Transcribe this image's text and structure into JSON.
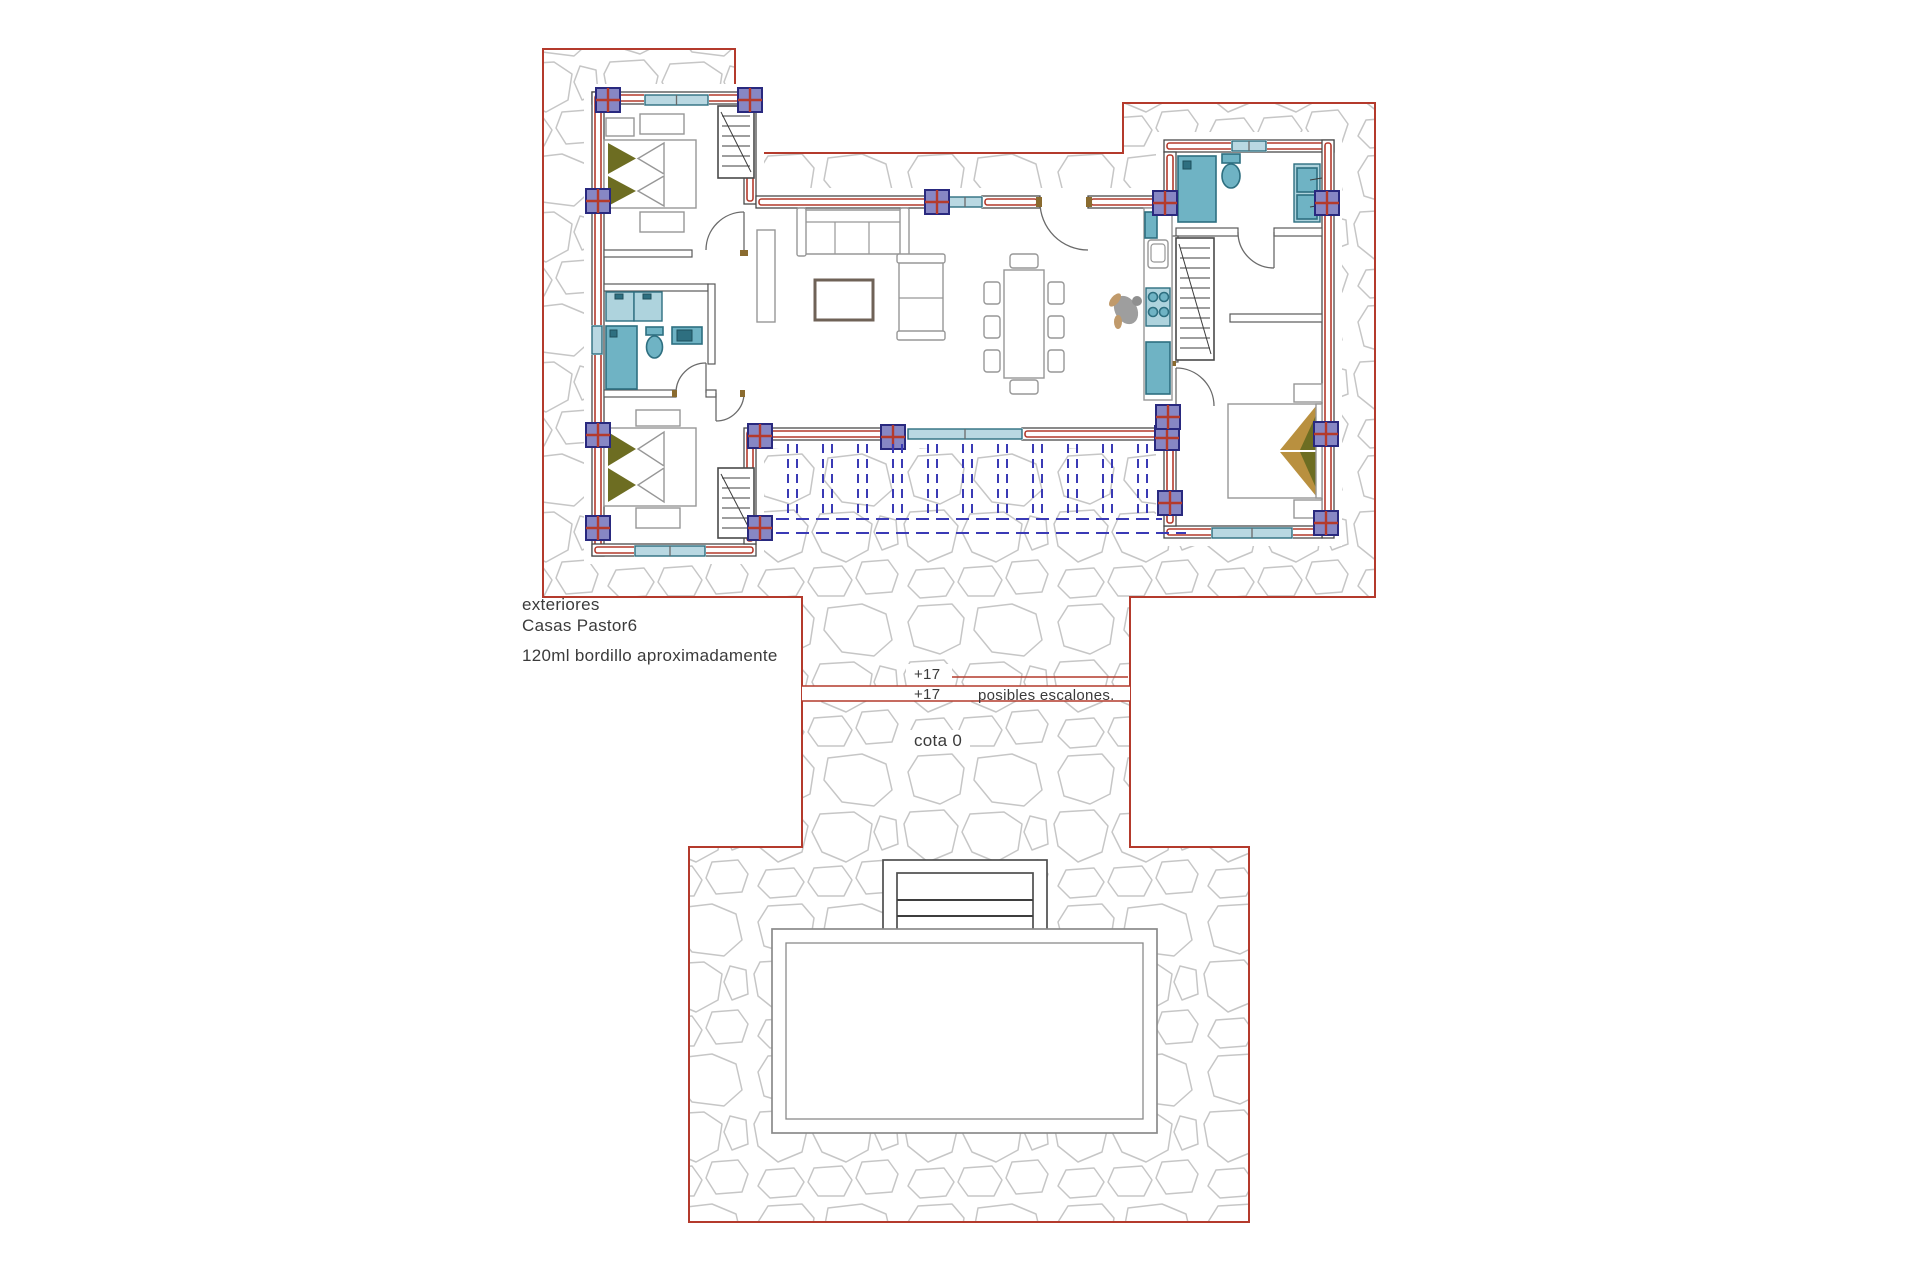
{
  "annotations": {
    "exteriores": "exteriores",
    "project": "Casas Pastor6",
    "bordillo": "120ml bordillo aproximadamente",
    "level_upper": "+17",
    "level_lower": "+17",
    "escalones": "posibles escalones.",
    "cota": "cota 0"
  },
  "colors": {
    "boundary_red": "#b43a2c",
    "wall_red": "#b43a2c",
    "stone_gray": "#c6c6c6",
    "column_fill": "#8787c4",
    "column_border": "#29297f",
    "fixture_teal": "#6fb3c4",
    "fixture_teal_light": "#aed3dd",
    "fixture_teal_dark": "#2e6f80",
    "window_fill": "#b9d8e2",
    "pergola_blue": "#3a3ab5",
    "olive": "#6d6d22",
    "tan": "#b9903f",
    "person_gray": "#9e9e9e",
    "jamb_tan": "#8a6b2f",
    "line_dark": "#4a4a4a",
    "text_dark": "#3b3b3b"
  }
}
